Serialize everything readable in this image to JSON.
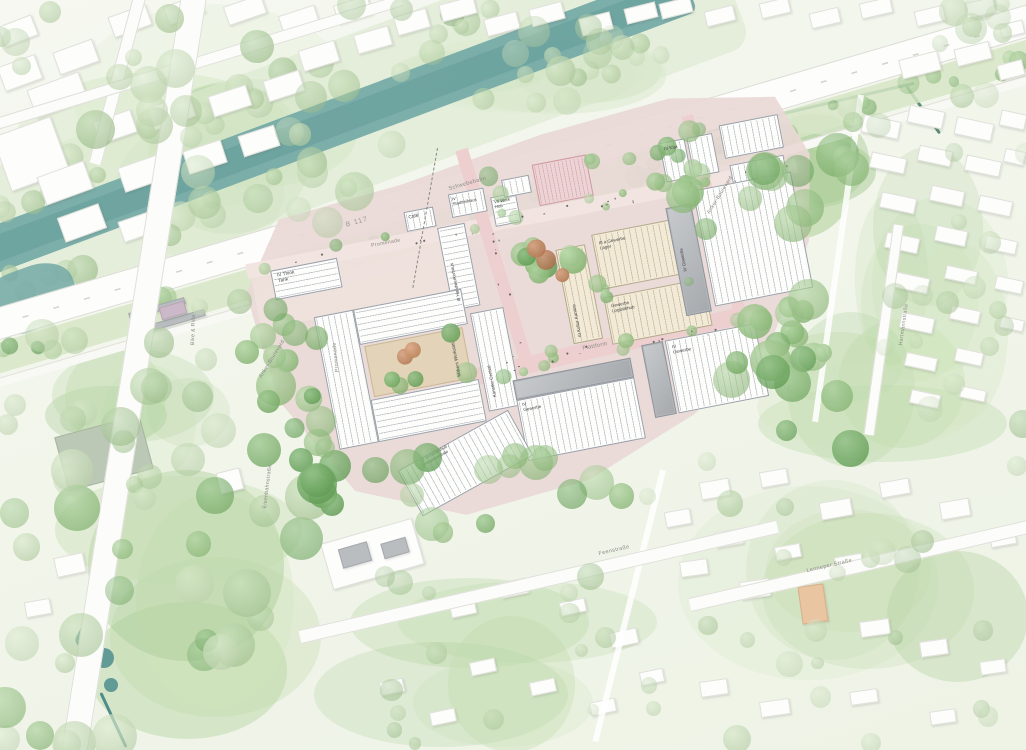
{
  "map": {
    "streets": {
      "b117": "B 117",
      "schwebebahn": "Schwebebahn",
      "promenade": "Promenade",
      "plattform": "Plattform",
      "anker_boulevard": "Anker-Boulevard",
      "feenstrasse": "Feenstraße",
      "lenneper_strasse": "Lenneper Straße",
      "eisenbahnstrasse": "Eisenbahnstraße",
      "hartmannstrasse": "Hartmannstraße",
      "bike_ride": "Bike & Ride"
    },
    "buildings": {
      "think_tank": "IV Think Tank",
      "cafe": "Café",
      "kita": "III Kita",
      "stadtteilhaus": "IV Stadtteilhaus",
      "work_hub": "VII Work Hub",
      "handwerkerhaus": "III Handwerkerhaus",
      "makers_werkstatt": "Makers Werkstatt",
      "kuenstler_central": "Künstler Central",
      "kultur_kantine": "III Kultur Kantine",
      "gewerbe_lager": "III a Gewerbe Lager",
      "gewerbe_logistikhub": "Gewerbe Logistikhub",
      "gewerbe_ost": "IV Gewerbe",
      "gewerbe_mitte": "IV Gewerbe",
      "gewerbe_sued": "IV Gewerbe",
      "mobilitaetshub": "VII Mobilitätshub / Energiezentrale"
    },
    "colors": {
      "river": "#74a9a7",
      "site_ground": "#e9d8d6",
      "road": "#fdfdfc",
      "tree_green": "#7db56b",
      "accent_orange": "#c5794e",
      "park_green": "#d9e7c8"
    }
  }
}
